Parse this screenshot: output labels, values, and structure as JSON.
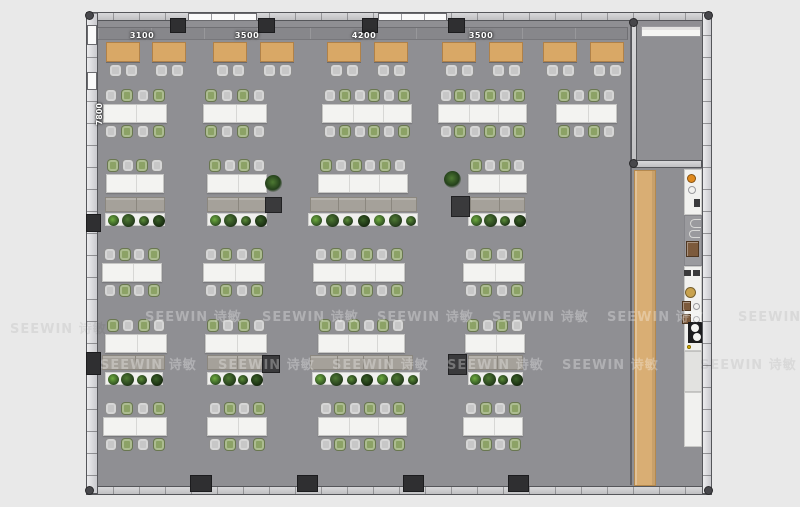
{
  "plan": {
    "watermark_text": "SEEWIN 诗敏",
    "watermarks_light": [
      [
        145,
        306
      ],
      [
        262,
        306
      ],
      [
        377,
        306
      ],
      [
        492,
        306
      ],
      [
        607,
        306
      ],
      [
        100,
        354
      ],
      [
        218,
        354
      ],
      [
        332,
        354
      ],
      [
        447,
        354
      ],
      [
        562,
        354
      ]
    ],
    "watermarks_dark": [
      [
        738,
        306
      ],
      [
        700,
        354
      ],
      [
        10,
        318
      ]
    ],
    "dimension_labels_top": [
      {
        "text": "3100",
        "x": 142,
        "y": 31
      },
      {
        "text": "3500",
        "x": 247,
        "y": 31
      },
      {
        "text": "4200",
        "x": 364,
        "y": 31
      },
      {
        "text": "3500",
        "x": 481,
        "y": 31
      }
    ],
    "dimension_label_left": {
      "text": "7800",
      "x": 95,
      "y": 103
    },
    "colors": {
      "floor": "#8f8f93",
      "page_bg": "#e9e9e9",
      "booth_table": "#d9a866",
      "wood_bar": "#d9ae74",
      "chair_gray": "#c7c7c7",
      "chair_green": "#8ca266",
      "desk": "#f3f3f1",
      "panel": "#a5a19a",
      "cabinet": "#3a3a3c",
      "column": "#2f2f31",
      "stove_orange": "#e08a1e",
      "coffee_brown": "#7c5a3c",
      "stove_black": "#1d1d1f",
      "tan_circle": "#c8a24e",
      "plant_dark": "#2e4d22",
      "plant_light": "#6da23f"
    },
    "building": {
      "x": 86,
      "y": 12,
      "w": 626,
      "h": 482,
      "wall": 10,
      "top_columns": [
        {
          "x": 170,
          "w": 16
        },
        {
          "x": 258,
          "w": 17
        },
        {
          "x": 362,
          "w": 16
        },
        {
          "x": 448,
          "w": 17
        }
      ],
      "top_windows": [
        {
          "x": 188,
          "w": 69
        },
        {
          "x": 378,
          "w": 69
        }
      ],
      "left_windows": [
        {
          "y": 25,
          "h": 20
        },
        {
          "y": 72,
          "h": 18
        }
      ],
      "left_columns": [
        {
          "y": 214,
          "h": 18
        },
        {
          "y": 352,
          "h": 23
        }
      ],
      "bottom_columns": [
        {
          "x": 190,
          "w": 22
        },
        {
          "x": 297,
          "w": 21
        },
        {
          "x": 403,
          "w": 21
        },
        {
          "x": 508,
          "w": 21
        }
      ],
      "separator_x": 630,
      "storage_room": {
        "wall_x": 631,
        "wall_w": 6,
        "top": 21,
        "bottom": 160,
        "floor_x": 637,
        "floor_w": 65,
        "shelf": {
          "x": 641,
          "y": 26,
          "w": 60,
          "h": 11
        }
      }
    },
    "booths": {
      "sofa": {
        "x": 97,
        "y": 27,
        "w": 531,
        "h": 13
      },
      "table_y": 42,
      "table_w": 34,
      "table_h": 20,
      "chair_y": 64,
      "tables_x": [
        106,
        152,
        213,
        260,
        327,
        374,
        442,
        489,
        543,
        590
      ]
    },
    "desk_rows": [
      {
        "type": "double",
        "deskY": 104,
        "clusters": [
          {
            "x": 103,
            "w": 64,
            "segs": 2,
            "start": "gray"
          },
          {
            "x": 203,
            "w": 64,
            "segs": 2,
            "start": "green"
          },
          {
            "x": 322,
            "w": 90,
            "segs": 3,
            "start": "gray"
          },
          {
            "x": 438,
            "w": 89,
            "segs": 3,
            "start": "gray"
          },
          {
            "x": 556,
            "w": 61,
            "segs": 2,
            "start": "green"
          }
        ]
      },
      {
        "type": "single",
        "deskY": 174,
        "panelY": 197,
        "planterY": 213,
        "clusters": [
          {
            "x": 106,
            "w": 58,
            "segs": 2,
            "start": "green",
            "panel": {
              "x": 105,
              "w": 60,
              "segs": 2
            },
            "planter": {
              "x": 105,
              "w": 60,
              "plants": 4
            }
          },
          {
            "x": 207,
            "w": 60,
            "segs": 2,
            "start": "green",
            "panel": {
              "x": 207,
              "w": 60,
              "segs": 2
            },
            "planter": {
              "x": 207,
              "w": 60,
              "plants": 4
            }
          },
          {
            "x": 318,
            "w": 90,
            "segs": 3,
            "start": "green",
            "panel": {
              "x": 310,
              "w": 107,
              "segs": 4
            },
            "planter": {
              "x": 308,
              "w": 110,
              "plants": 7
            }
          },
          {
            "x": 468,
            "w": 59,
            "segs": 2,
            "start": "green",
            "panel": {
              "x": 470,
              "w": 55,
              "segs": 2
            },
            "planter": {
              "x": 468,
              "w": 58,
              "plants": 4
            }
          }
        ]
      },
      {
        "type": "double",
        "deskY": 263,
        "clusters": [
          {
            "x": 102,
            "w": 60,
            "segs": 2,
            "start": "gray"
          },
          {
            "x": 203,
            "w": 62,
            "segs": 2,
            "start": "gray"
          },
          {
            "x": 313,
            "w": 92,
            "segs": 3,
            "start": "gray"
          },
          {
            "x": 463,
            "w": 62,
            "segs": 2,
            "start": "gray"
          }
        ]
      },
      {
        "type": "single",
        "deskY": 334,
        "panelY": 355,
        "planterY": 372,
        "clusters": [
          {
            "x": 105,
            "w": 62,
            "segs": 2,
            "start": "green",
            "panel": {
              "x": 102,
              "w": 63,
              "segs": 2
            },
            "planter": {
              "x": 105,
              "w": 58,
              "plants": 4
            }
          },
          {
            "x": 205,
            "w": 62,
            "segs": 2,
            "start": "green",
            "panel": {
              "x": 207,
              "w": 58,
              "segs": 2
            },
            "planter": {
              "x": 207,
              "w": 56,
              "plants": 4
            }
          },
          {
            "x": 318,
            "w": 87,
            "segs": 3,
            "start": "green",
            "panel": {
              "x": 310,
              "w": 103,
              "segs": 4
            },
            "planter": {
              "x": 312,
              "w": 108,
              "plants": 7
            }
          },
          {
            "x": 465,
            "w": 60,
            "segs": 2,
            "start": "green",
            "panel": {
              "x": 468,
              "w": 55,
              "segs": 2
            },
            "planter": {
              "x": 468,
              "w": 55,
              "plants": 4
            }
          }
        ]
      },
      {
        "type": "double",
        "deskY": 417,
        "clusters": [
          {
            "x": 103,
            "w": 64,
            "segs": 2,
            "start": "gray"
          },
          {
            "x": 207,
            "w": 60,
            "segs": 2,
            "start": "gray"
          },
          {
            "x": 318,
            "w": 89,
            "segs": 3,
            "start": "gray"
          },
          {
            "x": 463,
            "w": 60,
            "segs": 2,
            "start": "gray"
          }
        ]
      }
    ],
    "cabinets": [
      [
        265,
        197,
        17,
        16
      ],
      [
        451,
        196,
        19,
        21
      ],
      [
        262,
        355,
        18,
        18
      ],
      [
        448,
        354,
        19,
        21
      ]
    ],
    "loose_plants": [
      [
        265,
        175
      ],
      [
        444,
        171
      ]
    ],
    "corridor": {
      "wood_bar": {
        "x": 634,
        "y": 170,
        "w": 22,
        "h": 316
      },
      "counters": [
        {
          "x": 684,
          "y": 169,
          "w": 18,
          "h": 46,
          "tone": "white"
        },
        {
          "x": 684,
          "y": 215,
          "w": 18,
          "h": 51,
          "tone": "gray"
        },
        {
          "x": 684,
          "y": 266,
          "w": 18,
          "h": 85,
          "tone": "white"
        },
        {
          "x": 684,
          "y": 351,
          "w": 18,
          "h": 41,
          "tone": "light"
        },
        {
          "x": 684,
          "y": 392,
          "w": 18,
          "h": 55,
          "tone": "white"
        }
      ],
      "items": [
        {
          "type": "circle",
          "x": 687,
          "y": 174,
          "s": 9,
          "color": "#e08a1e"
        },
        {
          "type": "ring",
          "x": 688,
          "y": 186,
          "s": 8
        },
        {
          "type": "dark",
          "x": 694,
          "y": 199,
          "w": 6,
          "h": 8
        },
        {
          "type": "cglyph",
          "x": 690,
          "y": 219,
          "w": 11,
          "h": 9
        },
        {
          "type": "cglyph",
          "x": 689,
          "y": 230,
          "w": 11,
          "h": 8
        },
        {
          "type": "coffee",
          "x": 686,
          "y": 241,
          "w": 13,
          "h": 16
        },
        {
          "type": "dark",
          "x": 684,
          "y": 270,
          "w": 7,
          "h": 6
        },
        {
          "type": "dark",
          "x": 693,
          "y": 270,
          "w": 7,
          "h": 6
        },
        {
          "type": "circle",
          "x": 685,
          "y": 287,
          "s": 11,
          "color": "#c8a24e"
        },
        {
          "type": "coffee",
          "x": 682,
          "y": 301,
          "w": 9,
          "h": 10
        },
        {
          "type": "ring",
          "x": 693,
          "y": 303,
          "s": 7
        },
        {
          "type": "coffee",
          "x": 682,
          "y": 314,
          "w": 9,
          "h": 10
        },
        {
          "type": "ring",
          "x": 693,
          "y": 316,
          "s": 7
        },
        {
          "type": "stove",
          "x": 688,
          "y": 322,
          "w": 15,
          "h": 21
        },
        {
          "type": "circle",
          "x": 687,
          "y": 345,
          "s": 4,
          "color": "#e0b400"
        }
      ]
    }
  }
}
